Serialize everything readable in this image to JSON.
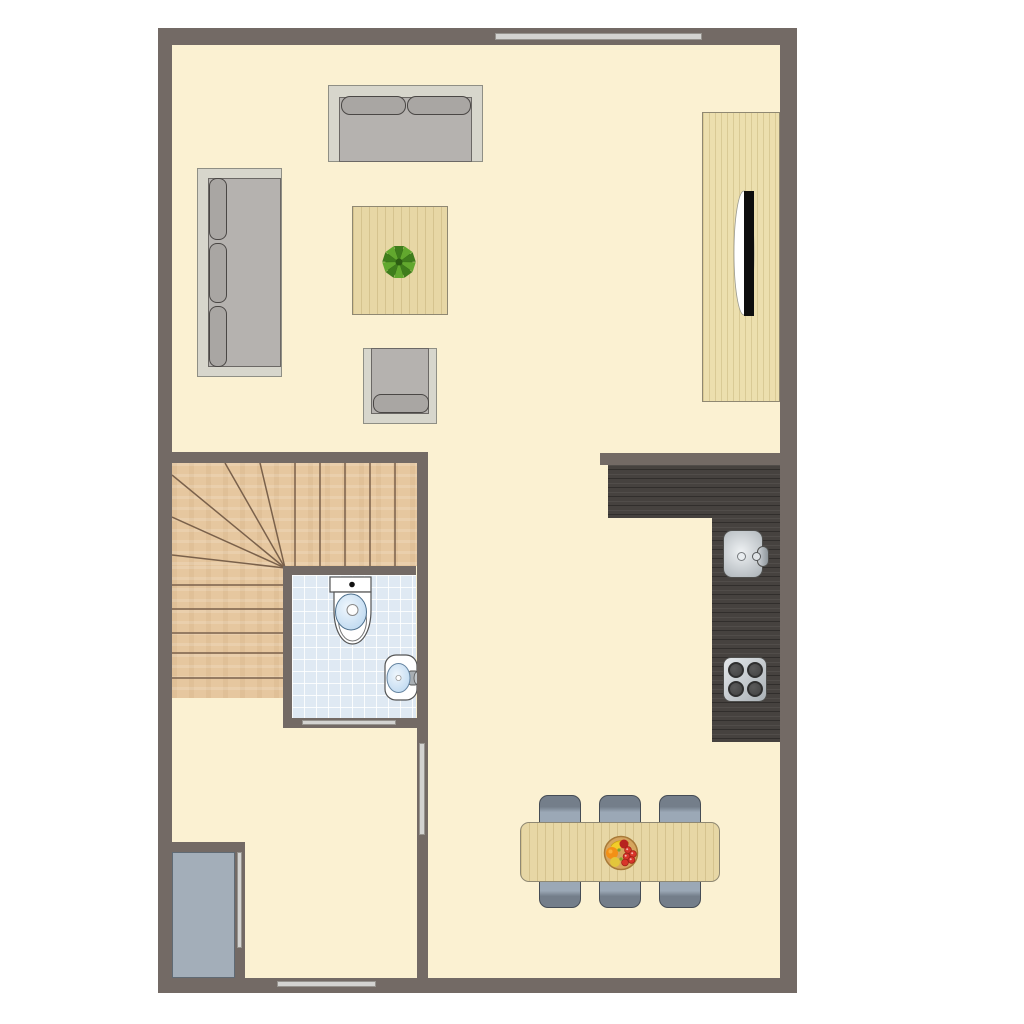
{
  "meta": {
    "kind": "architectural floor plan, top-down view",
    "text_content": "none (no visible text in image)"
  },
  "colors": {
    "wall": "#736a65",
    "floor": "#fbf1d2",
    "strip": "#d3d3d1",
    "stripBorder": "#96938e",
    "stairWood": "#e6c79f",
    "stairLine": "#7a614b",
    "bathTile": "#dfe9f3",
    "fixtureBorder": "#555555",
    "water": "#cfe3f5",
    "woodLight": "#ecdfae",
    "woodGrain": "rgba(150,125,60,0.22)",
    "tableWood": "#e7d7a5",
    "counter": "#46423f",
    "counterLight": "rgba(255,255,255,0.06)",
    "counterDark": "rgba(0,0,0,0.30)",
    "metalDeep": "#aab1b6",
    "metalBorder": "#4e4e4c",
    "burner": "#424242",
    "burnerRim": "#2f2f2f",
    "sofaFrame": "#d7d6cc",
    "sofaFrameBorder": "#8f8f85",
    "sofaSeat": "#b5b2af",
    "sofaSeatBorder": "#6b6865",
    "cushion": "#a9a6a3",
    "cushionBorder": "#4a4745",
    "chair": "#9ba8b6",
    "chairDark": "#747e8a",
    "chairBorder": "#454c55",
    "closet": "#a3aeb9",
    "closetBorder": "#5f6a74",
    "tv": "#0e0e0e",
    "plantDark": "#2c5c12",
    "plantMid": "#3f7d1c",
    "plantLight": "#62a82e",
    "bowl": "#d6a55e",
    "bowlRim": "#a87a38",
    "banana": "#f2cd2a",
    "orange": "#f39016",
    "pear": "#e3c63c",
    "apple": "#b7231f",
    "grape": "#d8352a",
    "grapeRim": "#9e1f16",
    "leafGreen": "#7fa32b"
  },
  "objects": {
    "rooms": [
      "living-area",
      "kitchen",
      "bathroom",
      "winder-staircase",
      "hallway",
      "dining-area",
      "storage-closet"
    ],
    "furniture": [
      "two-seat-sofa",
      "three-seat-sofa",
      "armchair",
      "coffee-table",
      "potted-plant",
      "tv-cabinet",
      "television",
      "toilet",
      "hand-basin",
      "kitchen-sink",
      "cooktop-4-burners",
      "dining-table",
      "dining-chairs-x6",
      "fruit-bowl"
    ],
    "openings": [
      "window-top-wall",
      "entrance-door-bottom-wall",
      "hallway-door",
      "closet-door",
      "bathroom-door"
    ],
    "dining_chair_count": 6
  }
}
